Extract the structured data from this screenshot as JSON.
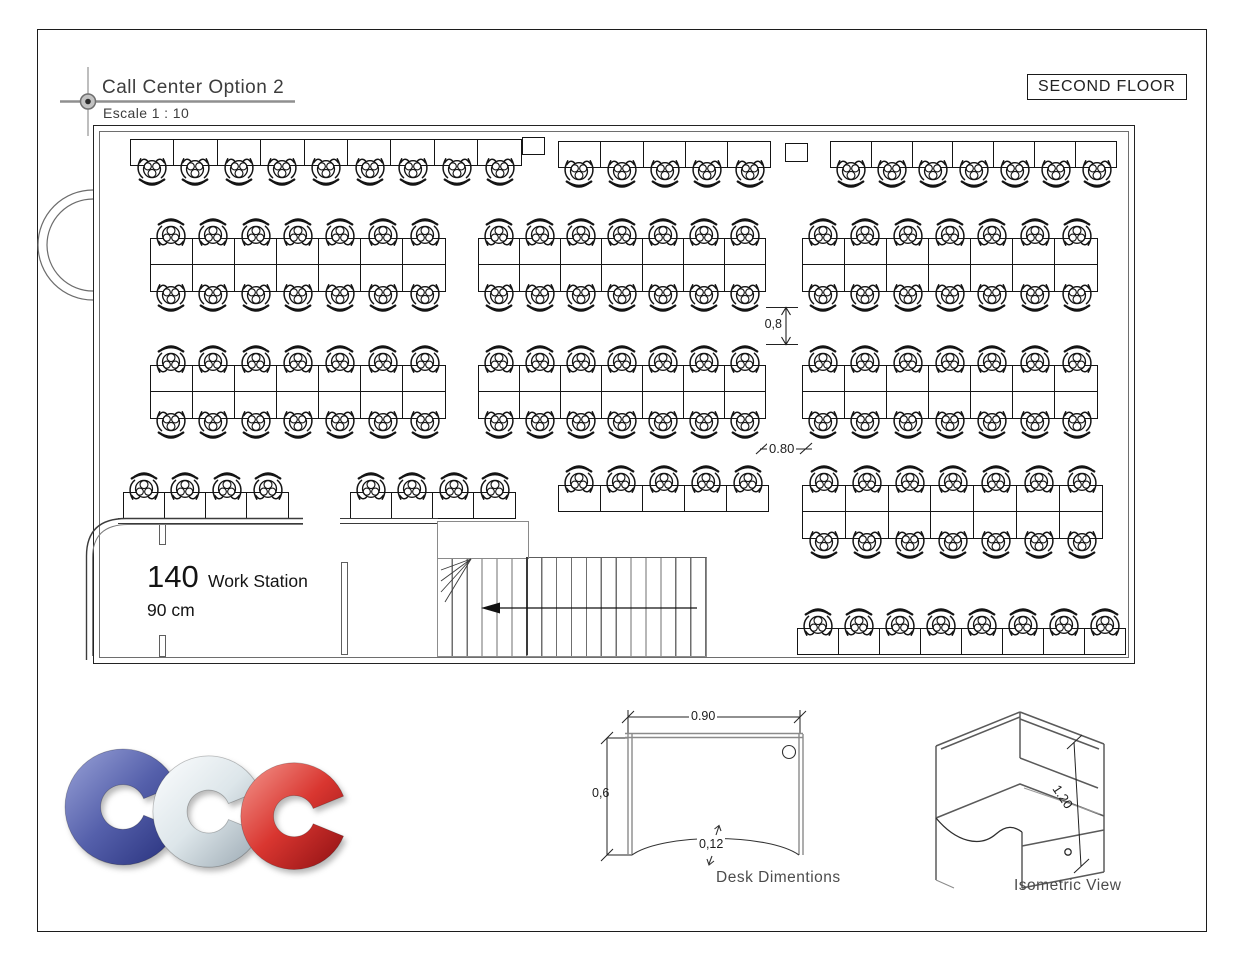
{
  "header": {
    "title": "Call Center Option 2",
    "scale": "Escale 1 : 10",
    "floor_badge": "SECOND FLOOR"
  },
  "plan": {
    "desk_h": 27,
    "chair_size": 32,
    "summary": {
      "count": "140",
      "label": "Work Station",
      "module": "90 cm"
    },
    "dims": {
      "aisle_v": "0,8",
      "aisle_h": "0.80"
    },
    "groups": [
      {
        "name": "top-row-left",
        "x": 130,
        "y": 139,
        "w": 392,
        "count": 9,
        "rows": 1,
        "chairs": "below"
      },
      {
        "name": "top-row-center",
        "x": 558,
        "y": 141,
        "w": 213,
        "count": 5,
        "rows": 1,
        "chairs": "below"
      },
      {
        "name": "top-row-right",
        "x": 830,
        "y": 141,
        "w": 287,
        "count": 7,
        "rows": 1,
        "chairs": "below"
      },
      {
        "name": "band1-left",
        "x": 150,
        "y": 238,
        "w": 296,
        "count": 7,
        "rows": 2,
        "chairs": "both"
      },
      {
        "name": "band1-center",
        "x": 478,
        "y": 238,
        "w": 288,
        "count": 7,
        "rows": 2,
        "chairs": "both"
      },
      {
        "name": "band1-right",
        "x": 802,
        "y": 238,
        "w": 296,
        "count": 7,
        "rows": 2,
        "chairs": "both"
      },
      {
        "name": "band2-left",
        "x": 150,
        "y": 365,
        "w": 296,
        "count": 7,
        "rows": 2,
        "chairs": "both"
      },
      {
        "name": "band2-center",
        "x": 478,
        "y": 365,
        "w": 288,
        "count": 7,
        "rows": 2,
        "chairs": "both"
      },
      {
        "name": "band2-right",
        "x": 802,
        "y": 365,
        "w": 296,
        "count": 7,
        "rows": 2,
        "chairs": "both"
      },
      {
        "name": "low-left-a",
        "x": 123,
        "y": 492,
        "w": 166,
        "count": 4,
        "rows": 1,
        "chairs": "above"
      },
      {
        "name": "low-left-b",
        "x": 350,
        "y": 492,
        "w": 166,
        "count": 4,
        "rows": 1,
        "chairs": "above"
      },
      {
        "name": "low-center",
        "x": 558,
        "y": 485,
        "w": 211,
        "count": 5,
        "rows": 1,
        "chairs": "above"
      },
      {
        "name": "low-right-cluster",
        "x": 802,
        "y": 485,
        "w": 301,
        "count": 7,
        "rows": 2,
        "chairs": "both"
      },
      {
        "name": "bottom-right-row",
        "x": 797,
        "y": 628,
        "w": 329,
        "count": 8,
        "rows": 1,
        "chairs": "above"
      }
    ],
    "pillars": [
      {
        "x": 522,
        "y": 137,
        "w": 21,
        "h": 16
      },
      {
        "x": 785,
        "y": 143,
        "w": 21,
        "h": 17
      }
    ]
  },
  "desk_detail": {
    "width": "0.90",
    "depth": "0,6",
    "cut": "0,12",
    "caption": "Desk Dimentions"
  },
  "isometric": {
    "height": "1.20",
    "caption": "Isometric View"
  },
  "logo": {
    "letters": [
      {
        "glyph": "C",
        "color_from": "#9aa3d8",
        "color_mid": "#5560ab",
        "color_to": "#27307c"
      },
      {
        "glyph": "C",
        "color_from": "#fdfeff",
        "color_mid": "#dde6ea",
        "color_to": "#99a7b1"
      },
      {
        "glyph": "C",
        "color_from": "#f4988f",
        "color_mid": "#d93630",
        "color_to": "#8e1013"
      }
    ]
  }
}
